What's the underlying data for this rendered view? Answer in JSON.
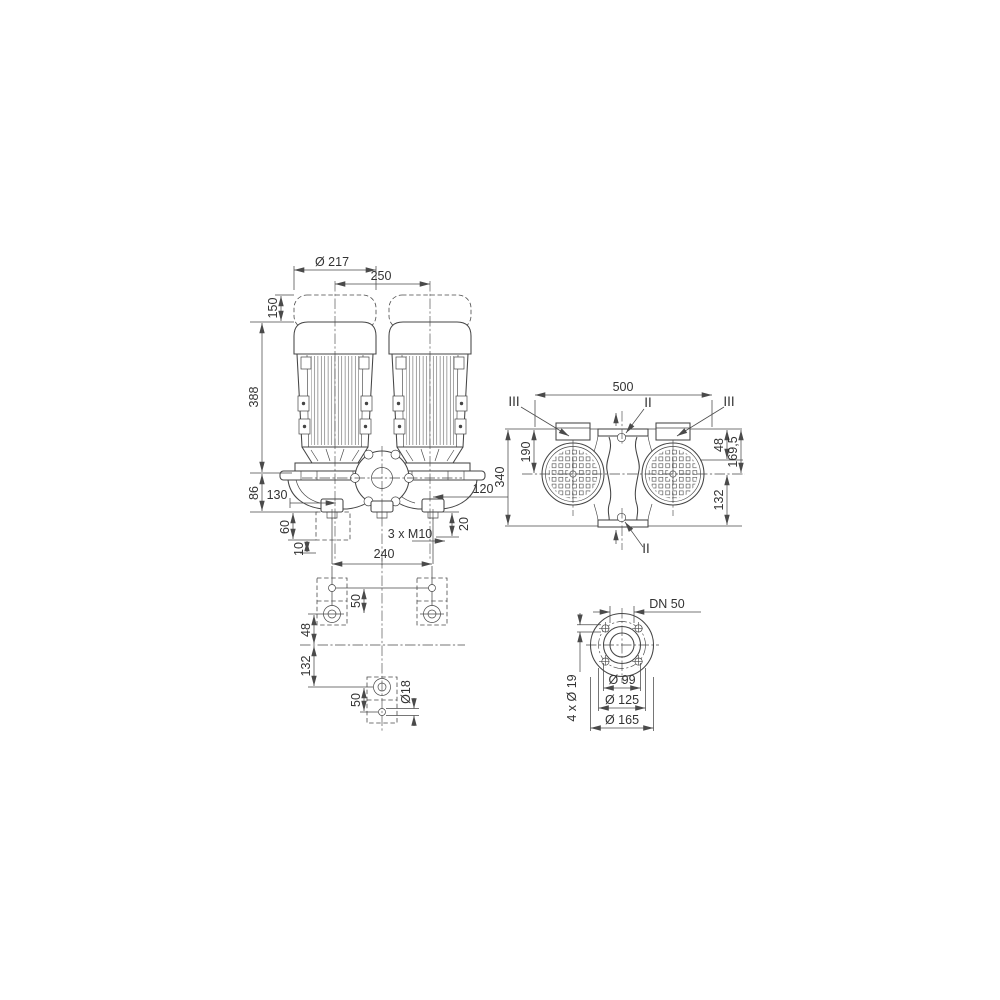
{
  "drawing": {
    "kind": "pump-dimension-drawing",
    "views": {
      "front": {
        "motor_diameter": "Ø 217",
        "axis_spacing": "250",
        "hood_clearance": "150",
        "motor_height": "388",
        "base_height": "86",
        "foot_offset_left": "130",
        "foot_offset_right": "120",
        "foundation_height": "60",
        "plate_thickness": "10",
        "foot_hole_offset": "20",
        "thread_spec": "3 x M10"
      },
      "top": {
        "overall_length": "500",
        "overall_depth": "340",
        "front_depth": "190",
        "box_depth": "48",
        "flange_depth": "169,5",
        "rear_depth": "132",
        "section_top": "II",
        "section_bottom": "II",
        "section_left": "III",
        "section_right": "III"
      },
      "foundation": {
        "bolt_spacing": "240",
        "hole_pitch_front": "50",
        "center_offset": "48",
        "rear_offset": "132",
        "hole_pitch_rear": "50",
        "hole_diameter": "Ø18"
      },
      "flange": {
        "nominal_diameter": "DN 50",
        "bolt_holes": "4 x Ø 19",
        "hub_diameter": "Ø 99",
        "bolt_circle": "Ø 125",
        "outer_diameter": "Ø 165"
      }
    }
  }
}
